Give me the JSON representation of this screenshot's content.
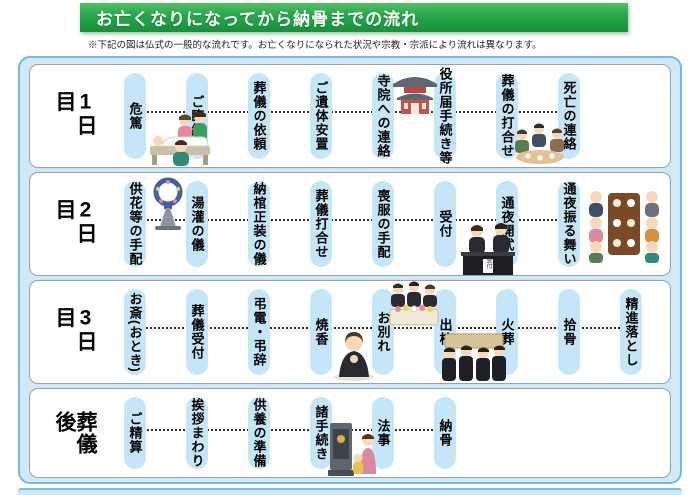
{
  "header": {
    "title": "お亡くなりになってから納骨までの流れ"
  },
  "note": "※下記の図は仏式の一般的な流れです。お亡くなりになられた状況や宗教・宗派により流れは異なります。",
  "reception_sign": "受付",
  "colors": {
    "header_green": "#28a84c",
    "container_bg": "#cfe9f8",
    "container_border": "#74b9e0",
    "pill_blue": "#c5e6f8",
    "row_border": "#98a2ad",
    "text": "#000000"
  },
  "rows": [
    {
      "label": "1日目",
      "items": [
        "危篤",
        "ご臨終",
        "葬儀の依頼",
        "ご遺体安置",
        "寺院への連絡",
        "役所届手続き等",
        "葬儀の打合せ",
        "死亡の連絡"
      ],
      "illustrations": [
        "deathbed-illustration",
        "temple-illustration",
        "meeting-illustration"
      ]
    },
    {
      "label": "2日目",
      "items": [
        "供花等の手配",
        "湯灌の儀",
        "納棺正装の儀",
        "葬儀打合せ",
        "喪服の手配",
        "受付",
        "通夜開式",
        "通夜振る舞い"
      ],
      "illustrations": [
        "flower-stand-illustration",
        "reception-desk-illustration",
        "wake-meal-illustration"
      ]
    },
    {
      "label": "3日目",
      "items": [
        "お斎(おとき)",
        "葬儀受付",
        "弔電・弔辞",
        "焼香",
        "お別れ",
        "出棺",
        "火葬",
        "拾骨",
        "精進落とし"
      ],
      "illustrations": [
        "incense-prayer-illustration",
        "coffin-farewell-illustration",
        "pallbearers-illustration"
      ]
    },
    {
      "label": "葬儀後",
      "items": [
        "ご精算",
        "挨拶まわり",
        "供養の準備",
        "諸手続き",
        "法事",
        "納骨"
      ],
      "illustrations": [
        "home-altar-illustration"
      ]
    }
  ]
}
